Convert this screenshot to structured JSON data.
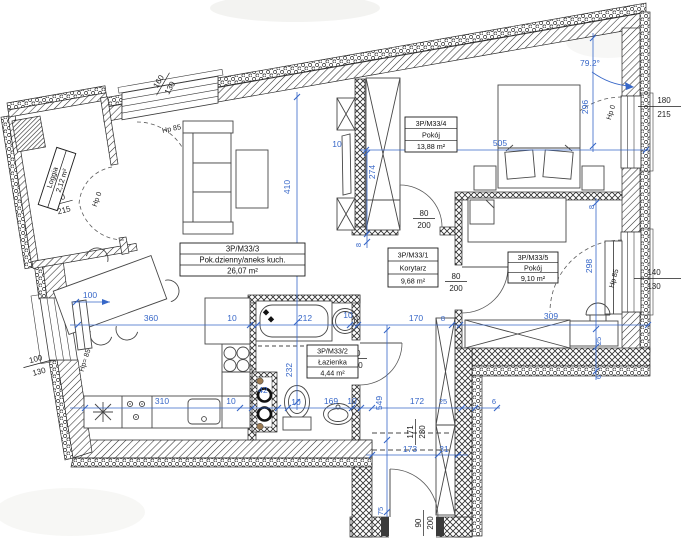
{
  "meta": {
    "drawing_type": "apartment floor plan",
    "units": "cm"
  },
  "rooms": {
    "living": {
      "id": "3P/M33/3",
      "name": "Pok.dzienny/aneks kuch.",
      "area": "26,07 m²"
    },
    "bedroom_large": {
      "id": "3P/M33/4",
      "name": "Pokój",
      "area": "13,88 m²"
    },
    "corridor": {
      "id": "3P/M33/1",
      "name": "Korytarz",
      "area": "9,68 m²"
    },
    "bedroom_small": {
      "id": "3P/M33/5",
      "name": "Pokój",
      "area": "9,10 m²"
    },
    "bathroom": {
      "id": "3P/M33/2",
      "name": "Łazienka",
      "area": "4,44 m²"
    },
    "loggia": {
      "name": "Loggia",
      "area": "2,12 m²"
    }
  },
  "dims_blue": {
    "living_height": "410",
    "bed4_left": "274",
    "w8_a": "8",
    "w10_top": "10",
    "bed4_width": "505",
    "right_top": "296",
    "corner_angle": "79.2°",
    "bed5_height": "298",
    "w8_b": "8",
    "w25_a": "25",
    "w6_a": "6",
    "kitchen_span": "360",
    "w10_b": "10",
    "bath_width": "212",
    "w10_c": "10",
    "corridor_width": "170",
    "w8_c": "8",
    "bed5_width": "309",
    "table_gap": "100",
    "bath_height": "232",
    "shaft": "42",
    "counter": "310",
    "w10_d": "10",
    "w10_e": "10",
    "wc_span": "169",
    "w10_f": "10",
    "entry_width": "172",
    "w25_b": "25",
    "w6_b": "6",
    "corridor_height": "549",
    "entry_lower": "173",
    "w31": "31",
    "w75": "75"
  },
  "dims_black": {
    "window_top": {
      "w": "160",
      "h": "130"
    },
    "hp_top": "Hp 85",
    "door_right": {
      "w": "180",
      "h": "215"
    },
    "hp_right_top": "Hp 0",
    "window_right": {
      "w": "140",
      "h": "130"
    },
    "hp_right_mid": "Hp 85",
    "window_left": {
      "w": "100",
      "h": "130"
    },
    "hp_left": "Hp= 85",
    "door_loggia": {
      "w": "80",
      "h": "215"
    },
    "hp_loggia": "Hp 0",
    "door_room4": {
      "w": "80",
      "h": "200"
    },
    "door_bath": {
      "w": "80",
      "h": "200"
    },
    "door_room5": {
      "w": "80",
      "h": "200"
    },
    "door_entry": {
      "w": "90",
      "h": "200"
    },
    "niche": {
      "w": "171",
      "h": "230"
    }
  },
  "colors": {
    "dimension_blue": "#3767c8",
    "wall_line": "#2b2b2b",
    "furniture_line": "#474747"
  }
}
